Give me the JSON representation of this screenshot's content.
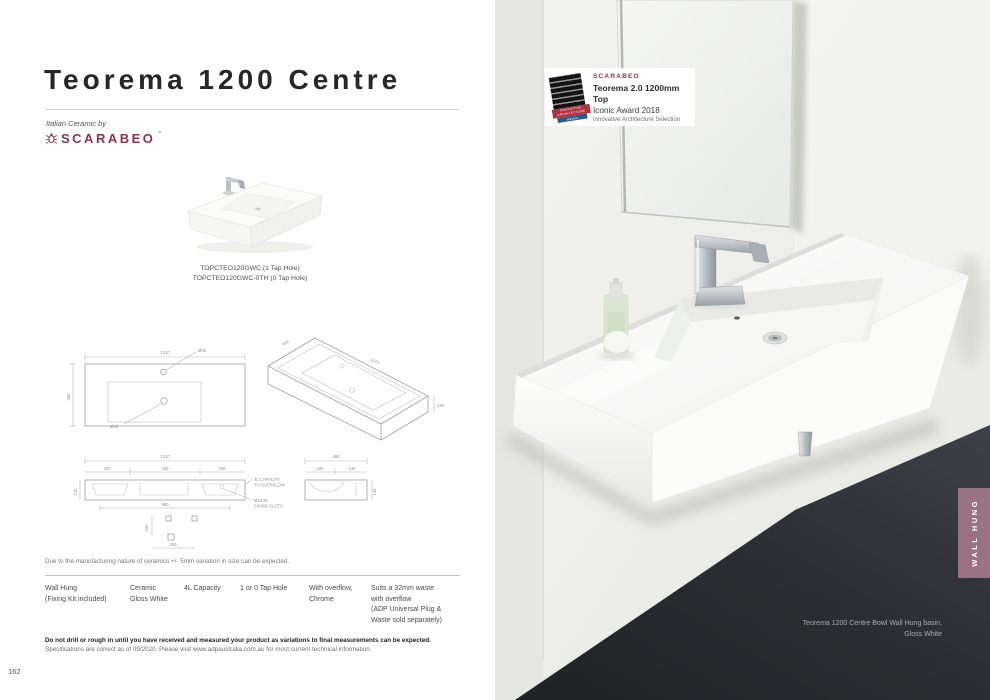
{
  "page": {
    "number": "162",
    "title": "Teorema 1200 Centre",
    "brand_tagline": "Italian Ceramic by",
    "brand_logo": "SCARABEO",
    "brand_mark": "°",
    "codes": {
      "line1": "TOPCTEO120GWC (1 Tap Hole)",
      "line2": "TOPCTEO120GWC-0TH (0 Tap Hole)"
    },
    "disclaimer": "Due to the manufacturing nature of ceramics +/- 5mm variation in size can be expected.",
    "note_bold": "Do not drill or rough in until you have received and measured your product as variations to final measurements can be expected.",
    "note_plain": "Specifications are correct as of 09/2020. Please visit www.adpaustralia.com.au for most current technical information."
  },
  "specs": {
    "install_1": "Wall Hung",
    "install_2": "(Fixing Kit included)",
    "material_1": "Ceramic",
    "material_2": "Gloss White",
    "capacity": "4L Capacity",
    "tap": "1 or 0 Tap Hole",
    "overflow_1": "With overflow,",
    "overflow_2": "Chrome",
    "waste_1": "Suits a 32mm waste",
    "waste_2": "with overflow",
    "waste_3": "(ADP Universal Plug &",
    "waste_4": "Waste sold separately)"
  },
  "drawings": {
    "plan": {
      "width": "1210",
      "depth": "460",
      "tap_hole": "Ø35",
      "waste": "Ø46"
    },
    "iso": {
      "depth": "460",
      "width": "1210",
      "height": "140"
    },
    "front": {
      "width": "1210",
      "seg_left": "320",
      "seg_centre": "440",
      "seg_right": "320",
      "height": "140",
      "span": "860",
      "fix_v": "150",
      "fix_h": "250",
      "note_cap_1": "4L CAPACITY",
      "note_cap_2": "TO OVERFLOW",
      "note_fix_1": "Ø16.35",
      "note_fix_2": "FIXING SLOTS"
    },
    "side": {
      "depth": "460",
      "back": "220",
      "front": "130",
      "height": "140"
    }
  },
  "award": {
    "brand": "SCARABEO",
    "line1": "Teorema 2.0 1200mm Top",
    "line2": "Iconic Award 2018",
    "line3": "Innovative Architecture Selection",
    "ribbon_top": "INNOVATIVE ARCHITECTURE",
    "ribbon_bottom": "selection"
  },
  "photo": {
    "caption_1": "Teorema 1200 Centre Bowl Wall Hung basin,",
    "caption_2": "Gloss White"
  },
  "side_tab": {
    "label": "WALL HUNG"
  },
  "colors": {
    "brand": "#8e3349",
    "tab": "#9b7284",
    "floor_dark": "#2b2d32",
    "award_red": "#b03040",
    "award_blue": "#275d8d"
  }
}
